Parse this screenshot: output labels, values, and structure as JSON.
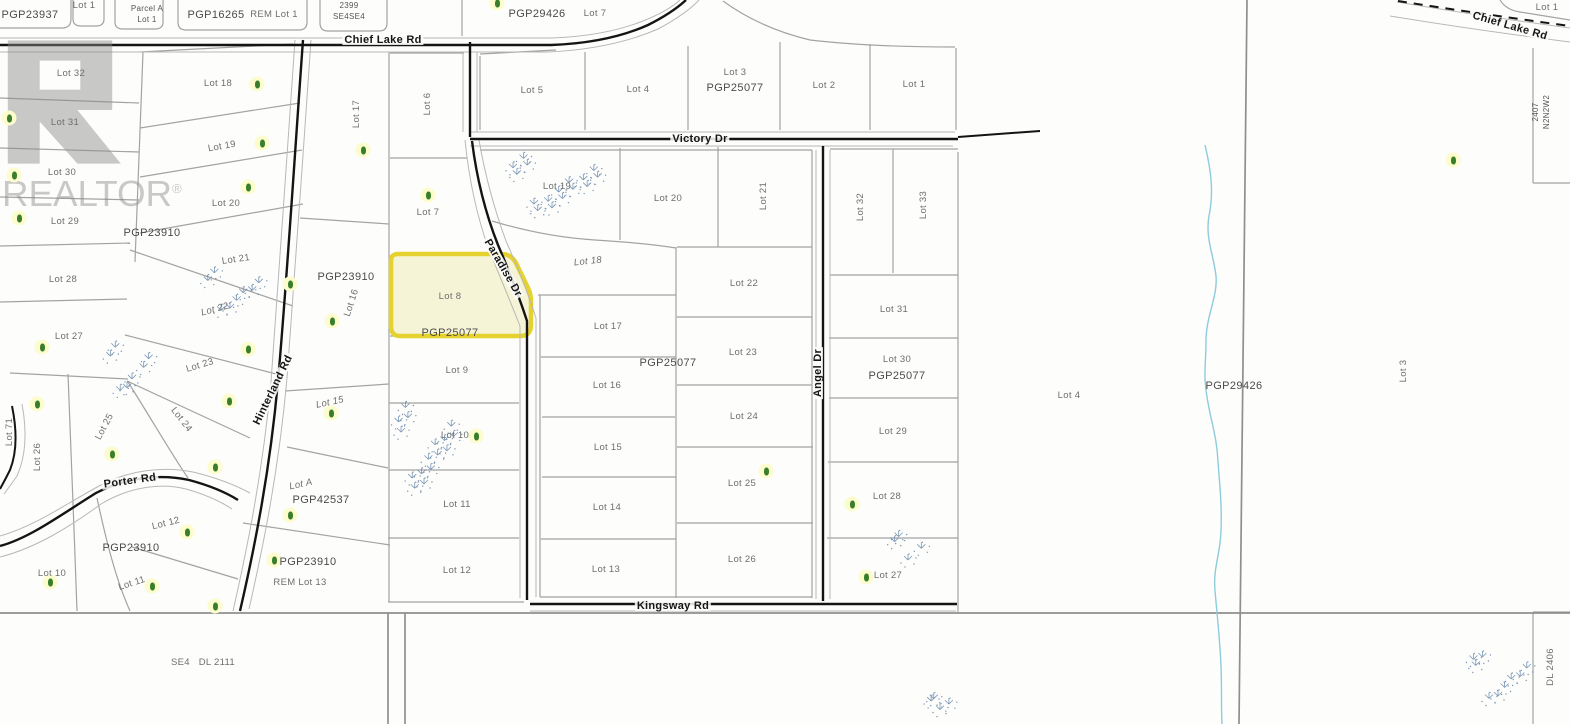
{
  "map": {
    "type": "cadastral plat map",
    "colors": {
      "background": "#fdfdfb",
      "parcel_line": "#a3a3a3",
      "road_line": "#141414",
      "tree": "#3a7e2d",
      "tree_halo": "#fcfccd",
      "marsh": "#5b7ea6",
      "stream": "#8ecbdc"
    },
    "watermark": {
      "text": "REALTOR",
      "registered": "®"
    },
    "highlight": {
      "lot": "Lot 8",
      "plan": "PGP25077",
      "fill": "#f5f4d6",
      "border": "#e6d22e"
    },
    "labels": [
      {
        "t": "Chief Lake Rd",
        "x": 383,
        "y": 40,
        "cls": "road"
      },
      {
        "t": "Chief Lake Rd",
        "x": 1510,
        "y": 26,
        "r": 16,
        "cls": "road"
      },
      {
        "t": "Victory Dr",
        "x": 700,
        "y": 139,
        "cls": "road"
      },
      {
        "t": "Paradise Dr",
        "x": 503,
        "y": 268,
        "r": 60,
        "cls": "road"
      },
      {
        "t": "Angel Dr",
        "x": 818,
        "y": 373,
        "r": -90,
        "cls": "road"
      },
      {
        "t": "Kingsway Rd",
        "x": 673,
        "y": 606,
        "cls": "road"
      },
      {
        "t": "Hinterland Rd",
        "x": 273,
        "y": 390,
        "r": -64,
        "cls": "road"
      },
      {
        "t": "Porter Rd",
        "x": 130,
        "y": 481,
        "r": -8,
        "cls": "road"
      },
      {
        "t": "PGP23937",
        "x": 30,
        "y": 15,
        "cls": "plan"
      },
      {
        "t": "Lot 1",
        "x": 84,
        "y": 6,
        "cls": "lot"
      },
      {
        "t": "Parcel A",
        "x": 147,
        "y": 9,
        "cls": "small"
      },
      {
        "t": "Lot 1",
        "x": 147,
        "y": 20,
        "cls": "small"
      },
      {
        "t": "PGP16265",
        "x": 216,
        "y": 15,
        "cls": "plan"
      },
      {
        "t": "REM Lot 1",
        "x": 274,
        "y": 15,
        "cls": "lot"
      },
      {
        "t": "2399",
        "x": 349,
        "y": 6,
        "cls": "small"
      },
      {
        "t": "SE4SE4",
        "x": 349,
        "y": 17,
        "cls": "small"
      },
      {
        "t": "PGP29426",
        "x": 537,
        "y": 14,
        "cls": "plan"
      },
      {
        "t": "Lot 7",
        "x": 595,
        "y": 14,
        "cls": "lot"
      },
      {
        "t": "Lot 1",
        "x": 1547,
        "y": 8,
        "cls": "lot"
      },
      {
        "t": "2407",
        "x": 1536,
        "y": 112,
        "r": -90,
        "cls": "small"
      },
      {
        "t": "N2N2W2",
        "x": 1547,
        "y": 112,
        "r": -90,
        "cls": "small"
      },
      {
        "t": "Lot 32",
        "x": 71,
        "y": 74,
        "cls": "lot"
      },
      {
        "t": "Lot 31",
        "x": 65,
        "y": 123,
        "cls": "lot"
      },
      {
        "t": "Lot 30",
        "x": 62,
        "y": 173,
        "cls": "lot"
      },
      {
        "t": "Lot 29",
        "x": 65,
        "y": 222,
        "cls": "lot"
      },
      {
        "t": "Lot 28",
        "x": 63,
        "y": 280,
        "cls": "lot"
      },
      {
        "t": "Lot 27",
        "x": 69,
        "y": 337,
        "cls": "lot"
      },
      {
        "t": "Lot 26",
        "x": 38,
        "y": 457,
        "r": -90,
        "cls": "lot"
      },
      {
        "t": "Lot 25",
        "x": 105,
        "y": 427,
        "r": -62,
        "cls": "lot"
      },
      {
        "t": "Lot 71",
        "x": 10,
        "y": 432,
        "r": -90,
        "cls": "lot"
      },
      {
        "t": "Lot 18",
        "x": 218,
        "y": 84,
        "cls": "lot"
      },
      {
        "t": "Lot 19",
        "x": 222,
        "y": 147,
        "r": -10,
        "cls": "lot"
      },
      {
        "t": "Lot 20",
        "x": 226,
        "y": 204,
        "cls": "lot"
      },
      {
        "t": "PGP23910",
        "x": 152,
        "y": 233,
        "cls": "plan"
      },
      {
        "t": "Lot 21",
        "x": 236,
        "y": 260,
        "r": -8,
        "cls": "lot"
      },
      {
        "t": "Lot 22",
        "x": 215,
        "y": 310,
        "r": -15,
        "cls": "lot i"
      },
      {
        "t": "Lot 23",
        "x": 200,
        "y": 366,
        "r": -17,
        "cls": "lot"
      },
      {
        "t": "Lot 24",
        "x": 181,
        "y": 420,
        "r": 52,
        "cls": "lot"
      },
      {
        "t": "Lot 10",
        "x": 52,
        "y": 574,
        "cls": "lot"
      },
      {
        "t": "Lot 11",
        "x": 132,
        "y": 584,
        "r": -18,
        "cls": "lot"
      },
      {
        "t": "Lot 12",
        "x": 166,
        "y": 524,
        "r": -14,
        "cls": "lot"
      },
      {
        "t": "PGP23910",
        "x": 131,
        "y": 548,
        "cls": "plan"
      },
      {
        "t": "PGP23910",
        "x": 308,
        "y": 562,
        "cls": "plan"
      },
      {
        "t": "REM Lot 13",
        "x": 300,
        "y": 583,
        "cls": "lot"
      },
      {
        "t": "Lot A",
        "x": 301,
        "y": 485,
        "r": -12,
        "cls": "lot i"
      },
      {
        "t": "PGP42537",
        "x": 321,
        "y": 500,
        "cls": "plan"
      },
      {
        "t": "Lot 15",
        "x": 330,
        "y": 403,
        "r": -12,
        "cls": "lot i"
      },
      {
        "t": "Lot 16",
        "x": 352,
        "y": 303,
        "r": -72,
        "cls": "lot"
      },
      {
        "t": "Lot 17",
        "x": 357,
        "y": 114,
        "r": -90,
        "cls": "lot"
      },
      {
        "t": "PGP23910",
        "x": 346,
        "y": 277,
        "cls": "plan"
      },
      {
        "t": "Lot 6",
        "x": 428,
        "y": 104,
        "r": -90,
        "cls": "lot"
      },
      {
        "t": "Lot 7",
        "x": 428,
        "y": 213,
        "cls": "lot"
      },
      {
        "t": "Lot 8",
        "x": 450,
        "y": 297,
        "cls": "lot"
      },
      {
        "t": "PGP25077",
        "x": 450,
        "y": 333,
        "cls": "plan"
      },
      {
        "t": "Lot 9",
        "x": 457,
        "y": 371,
        "cls": "lot"
      },
      {
        "t": "Lot 10",
        "x": 455,
        "y": 436,
        "cls": "lot"
      },
      {
        "t": "Lot 11",
        "x": 457,
        "y": 505,
        "cls": "lot"
      },
      {
        "t": "Lot 12",
        "x": 457,
        "y": 571,
        "cls": "lot"
      },
      {
        "t": "Lot 5",
        "x": 532,
        "y": 91,
        "cls": "lot"
      },
      {
        "t": "Lot 4",
        "x": 638,
        "y": 90,
        "cls": "lot"
      },
      {
        "t": "Lot 3",
        "x": 735,
        "y": 73,
        "cls": "lot"
      },
      {
        "t": "PGP25077",
        "x": 735,
        "y": 88,
        "cls": "plan"
      },
      {
        "t": "Lot 2",
        "x": 824,
        "y": 86,
        "cls": "lot"
      },
      {
        "t": "Lot 1",
        "x": 914,
        "y": 85,
        "cls": "lot"
      },
      {
        "t": "Lot 19",
        "x": 557,
        "y": 187,
        "cls": "lot"
      },
      {
        "t": "Lot 20",
        "x": 668,
        "y": 199,
        "cls": "lot"
      },
      {
        "t": "Lot 21",
        "x": 764,
        "y": 196,
        "r": -90,
        "cls": "lot"
      },
      {
        "t": "Lot 18",
        "x": 588,
        "y": 262,
        "r": -6,
        "cls": "lot i"
      },
      {
        "t": "Lot 22",
        "x": 744,
        "y": 284,
        "cls": "lot"
      },
      {
        "t": "Lot 17",
        "x": 608,
        "y": 327,
        "cls": "lot"
      },
      {
        "t": "Lot 23",
        "x": 743,
        "y": 353,
        "cls": "lot"
      },
      {
        "t": "Lot 16",
        "x": 607,
        "y": 386,
        "cls": "lot"
      },
      {
        "t": "PGP25077",
        "x": 668,
        "y": 363,
        "cls": "plan"
      },
      {
        "t": "Lot 24",
        "x": 744,
        "y": 417,
        "cls": "lot"
      },
      {
        "t": "Lot 15",
        "x": 608,
        "y": 448,
        "cls": "lot"
      },
      {
        "t": "Lot 25",
        "x": 742,
        "y": 484,
        "cls": "lot"
      },
      {
        "t": "Lot 14",
        "x": 607,
        "y": 508,
        "cls": "lot"
      },
      {
        "t": "Lot 26",
        "x": 742,
        "y": 560,
        "cls": "lot"
      },
      {
        "t": "Lot 13",
        "x": 606,
        "y": 570,
        "cls": "lot"
      },
      {
        "t": "Lot 32",
        "x": 861,
        "y": 207,
        "r": -90,
        "cls": "lot"
      },
      {
        "t": "Lot 33",
        "x": 924,
        "y": 205,
        "r": -90,
        "cls": "lot"
      },
      {
        "t": "Lot 31",
        "x": 894,
        "y": 310,
        "cls": "lot"
      },
      {
        "t": "Lot 30",
        "x": 897,
        "y": 360,
        "cls": "lot"
      },
      {
        "t": "PGP25077",
        "x": 897,
        "y": 376,
        "cls": "plan"
      },
      {
        "t": "Lot 29",
        "x": 893,
        "y": 432,
        "cls": "lot"
      },
      {
        "t": "Lot 28",
        "x": 887,
        "y": 497,
        "cls": "lot"
      },
      {
        "t": "Lot 27",
        "x": 888,
        "y": 576,
        "cls": "lot"
      },
      {
        "t": "Lot 4",
        "x": 1069,
        "y": 396,
        "cls": "lot"
      },
      {
        "t": "PGP29426",
        "x": 1234,
        "y": 386,
        "cls": "plan"
      },
      {
        "t": "Lot 3",
        "x": 1404,
        "y": 371,
        "r": -90,
        "cls": "lot"
      },
      {
        "t": "DL 2406",
        "x": 1551,
        "y": 667,
        "r": -90,
        "cls": "lot"
      },
      {
        "t": "SE4   DL 2111",
        "x": 203,
        "y": 663,
        "cls": "lot"
      }
    ],
    "trees": [
      {
        "x": 497,
        "y": 3
      },
      {
        "x": 9,
        "y": 118
      },
      {
        "x": 14,
        "y": 175
      },
      {
        "x": 19,
        "y": 218
      },
      {
        "x": 257,
        "y": 84
      },
      {
        "x": 262,
        "y": 143
      },
      {
        "x": 248,
        "y": 187
      },
      {
        "x": 42,
        "y": 347
      },
      {
        "x": 37,
        "y": 404
      },
      {
        "x": 290,
        "y": 284
      },
      {
        "x": 332,
        "y": 321
      },
      {
        "x": 248,
        "y": 349
      },
      {
        "x": 229,
        "y": 401
      },
      {
        "x": 112,
        "y": 454
      },
      {
        "x": 215,
        "y": 467
      },
      {
        "x": 331,
        "y": 413
      },
      {
        "x": 290,
        "y": 515
      },
      {
        "x": 187,
        "y": 532
      },
      {
        "x": 274,
        "y": 560
      },
      {
        "x": 50,
        "y": 582
      },
      {
        "x": 152,
        "y": 586
      },
      {
        "x": 215,
        "y": 606
      },
      {
        "x": 363,
        "y": 150
      },
      {
        "x": 428,
        "y": 195
      },
      {
        "x": 476,
        "y": 436
      },
      {
        "x": 766,
        "y": 471
      },
      {
        "x": 852,
        "y": 504
      },
      {
        "x": 866,
        "y": 577
      },
      {
        "x": 1453,
        "y": 160
      }
    ],
    "marshes": [
      {
        "x": 230,
        "y": 290,
        "w": 60,
        "h": 45
      },
      {
        "x": 127,
        "y": 367,
        "w": 45,
        "h": 52
      },
      {
        "x": 552,
        "y": 186,
        "w": 95,
        "h": 55
      },
      {
        "x": 424,
        "y": 450,
        "w": 62,
        "h": 85
      },
      {
        "x": 908,
        "y": 548,
        "w": 36,
        "h": 30
      },
      {
        "x": 940,
        "y": 704,
        "w": 24,
        "h": 14
      },
      {
        "x": 1498,
        "y": 676,
        "w": 60,
        "h": 50
      }
    ]
  }
}
